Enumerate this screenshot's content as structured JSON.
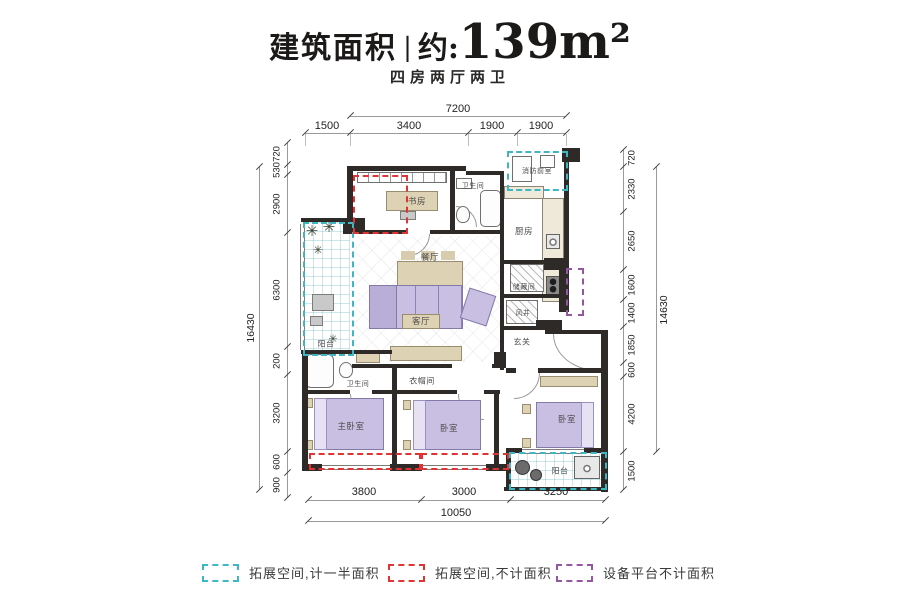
{
  "header": {
    "title_name": "建筑面积",
    "title_separator": "|",
    "title_approx": "约:",
    "area": "139m²",
    "subtitle": "四房两厅两卫"
  },
  "dimensions": {
    "top": {
      "total": "7200",
      "segments": [
        "1500",
        "3400",
        "1900",
        "1900"
      ]
    },
    "bottom": {
      "segments": [
        "3800",
        "3000",
        "3250"
      ],
      "total": "10050"
    },
    "left": {
      "total": "16430",
      "segments": [
        "720",
        "530",
        "2900",
        "6300",
        "200",
        "3200",
        "600",
        "900"
      ]
    },
    "right": {
      "segments": [
        "720",
        "2330",
        "2650",
        "1600",
        "1400",
        "1850",
        "600",
        "4200",
        "1500"
      ],
      "total": "14630"
    }
  },
  "rooms": {
    "study": "书房",
    "bath1": "卫生间",
    "fire_lobby": "消防前室",
    "kitchen": "厨房",
    "dining": "餐厅",
    "balcony1": "阳台",
    "living": "客厅",
    "storage": "储藏间",
    "shaft": "风井",
    "foyer": "玄关",
    "bath2": "卫生间",
    "cloakroom": "衣帽间",
    "master_bedroom": "主卧室",
    "bedroom2": "卧室",
    "bedroom3": "卧室",
    "balcony2": "阳台"
  },
  "legend": {
    "items": [
      {
        "label": "拓展空间,计一半面积",
        "color": "#3fb6c4"
      },
      {
        "label": "拓展空间,不计面积",
        "color": "#e03434"
      },
      {
        "label": "设备平台不计面积",
        "color": "#9455a3"
      }
    ]
  },
  "colors": {
    "wall": "#2e2a28",
    "dimension_line": "#9a9a9a",
    "cyan_dashed": "#3fb6c4",
    "red_dashed": "#e03434",
    "purple_dashed": "#9455a3",
    "furniture_purple": "#c9bfe3",
    "furniture_tan": "#ded2b4"
  }
}
